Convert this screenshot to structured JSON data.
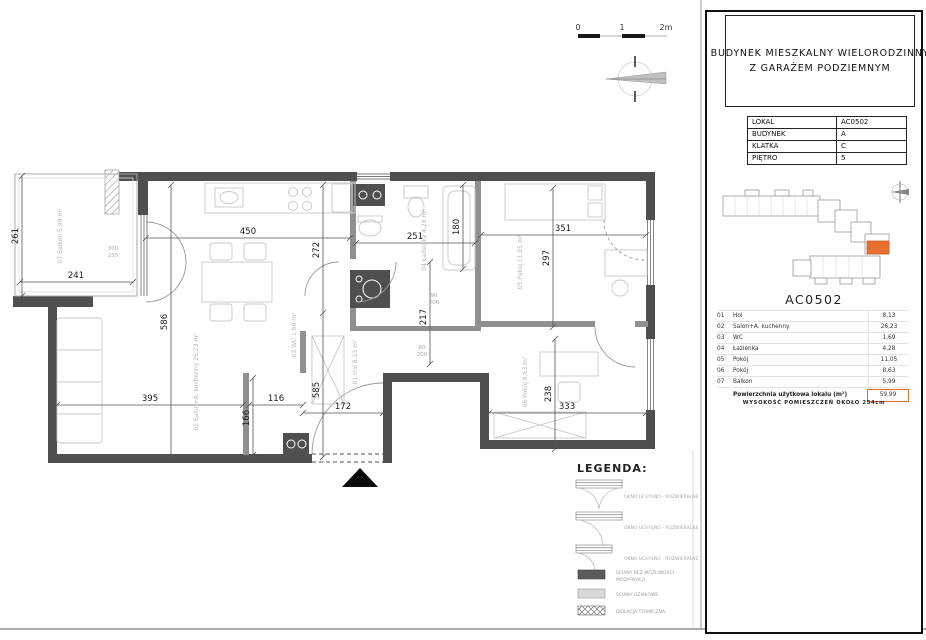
{
  "scale_bar": {
    "t0": "0",
    "t1": "1",
    "t2": "2m"
  },
  "plan": {
    "dims": {
      "d261": "261",
      "d241": "241",
      "d450": "450",
      "d272": "272",
      "d586": "586",
      "d585": "585",
      "d251": "251",
      "d180": "180",
      "d217": "217",
      "d351": "351",
      "d297": "297",
      "d238": "238",
      "d333": "333",
      "d395": "395",
      "d116": "116",
      "d172": "172",
      "d166": "166"
    },
    "room_labels": {
      "balkon": "07  Balkon  5,99 m²",
      "salon": "02  Salon+A. kuchenny  26,23 m²",
      "wc": "03  WC  1,69 m²",
      "lazienka": "04  Łazienka  4,28 m²",
      "hol": "01  Hol  8,13 m²",
      "pokoj5": "05  Pokój  11,05 m²",
      "pokoj6": "06  Pokój  8,63 m²"
    },
    "marks": {
      "win_w": "300",
      "win_h": "235",
      "door1_w": "90",
      "door1_h": "200",
      "door2_w": "80",
      "door2_h": "200"
    }
  },
  "legend": {
    "title": "LEGENDA:",
    "window_items": [
      {
        "label": "OKNO UCHYLNO - ROZWIERALNE"
      },
      {
        "label": "OKNO UCHYLNO - ROZWIERALNE"
      },
      {
        "label": "OKNO UCHYLNO - ROZWIERALNE"
      }
    ],
    "wall_solid_line1": "ŚCIANY BEZ MOŻLIWOŚCI",
    "wall_solid_line2": "MODYFIKACJI",
    "wall_partition": "ŚCIANY DZIAŁOWE",
    "insulation": "IZOLACJA TERMICZNA"
  },
  "panel": {
    "title_line1": "BUDYNEK  MIESZKALNY  WIELORODZINNY",
    "title_line2": "Z GARAŻEM PODZIEMNYM",
    "info": [
      {
        "label": "LOKAL",
        "value": "AC0502"
      },
      {
        "label": "BUDYNEK",
        "value": "A"
      },
      {
        "label": "KLATKA",
        "value": "C"
      },
      {
        "label": "PIĘTRO",
        "value": "5"
      }
    ],
    "unit_heading": "AC0502",
    "rooms": [
      {
        "no": "01",
        "name": "Hol",
        "area": "8,13"
      },
      {
        "no": "02",
        "name": "Salon+A. kuchenny",
        "area": "26,23"
      },
      {
        "no": "03",
        "name": "WC",
        "area": "1,69"
      },
      {
        "no": "04",
        "name": "Łazienka",
        "area": "4,28"
      },
      {
        "no": "05",
        "name": "Pokój",
        "area": "11,05"
      },
      {
        "no": "06",
        "name": "Pokój",
        "area": "8,63"
      },
      {
        "no": "07",
        "name": "Balkon",
        "area": "5,99"
      }
    ],
    "total_label": "Powierzchnia użytkowa lokalu (m²)",
    "total_value": "59,99",
    "footer": "WYSOKOŚĆ POMIESZCZEŃ OKOŁO 254cm",
    "accent_color": "#e06a2b"
  }
}
